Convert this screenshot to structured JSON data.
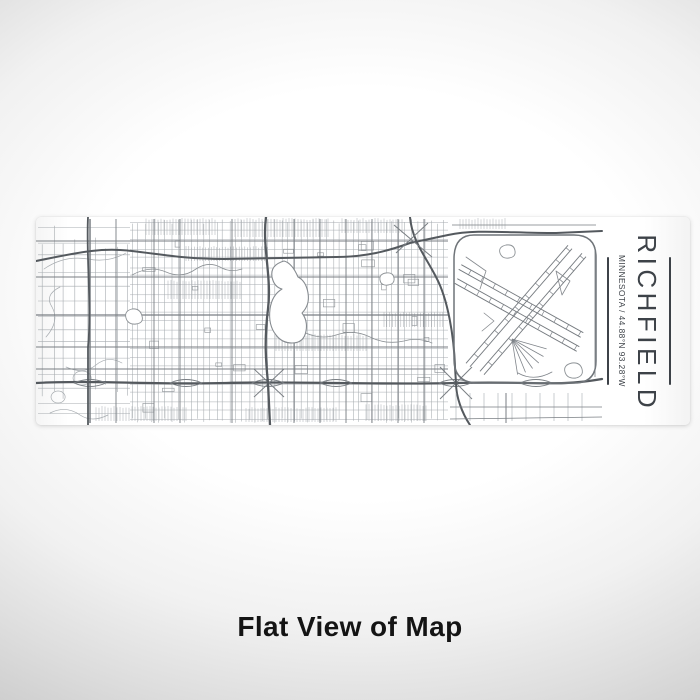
{
  "product": {
    "title": "RICHFIELD",
    "subtitle": "MINNESOTA / 44.88°N 93.28°W",
    "caption": "Flat View of Map"
  },
  "colors": {
    "backdrop_center": "#ffffff",
    "backdrop_edge": "#cecece",
    "panel": "#ffffff",
    "street_fine": "#a7acb0",
    "street_major": "#797e83",
    "highway": "#54595e",
    "water_outline": "#8d9296",
    "label_text": "#3d4248",
    "caption_text": "#141414"
  }
}
